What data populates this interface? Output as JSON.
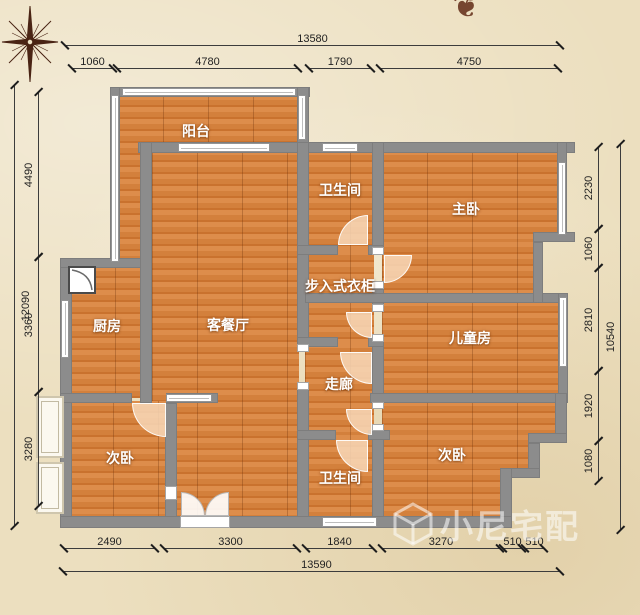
{
  "plan_title": "residential floor plan",
  "rooms": [
    {
      "id": "balcony",
      "label": "阳台"
    },
    {
      "id": "bathroom-top",
      "label": "卫生间"
    },
    {
      "id": "master-bedroom",
      "label": "主卧"
    },
    {
      "id": "walk-in-closet",
      "label": "步入式衣柜"
    },
    {
      "id": "kitchen",
      "label": "厨房"
    },
    {
      "id": "living-dining",
      "label": "客餐厅"
    },
    {
      "id": "kids-room",
      "label": "儿童房"
    },
    {
      "id": "corridor",
      "label": "走廊"
    },
    {
      "id": "bedroom-left",
      "label": "次卧"
    },
    {
      "id": "bathroom-bottom",
      "label": "卫生间"
    },
    {
      "id": "bedroom-right",
      "label": "次卧"
    }
  ],
  "dimensions": {
    "top": {
      "overall": "13580",
      "segments": [
        "1060",
        "4780",
        "1790",
        "4750"
      ]
    },
    "bottom": {
      "overall": "13590",
      "segments": [
        "2490",
        "3300",
        "1840",
        "3270",
        "510",
        "510"
      ]
    },
    "left": {
      "overall": "12090",
      "segments": [
        "4490",
        "3360",
        "3280"
      ]
    },
    "right": {
      "overall": "10540",
      "segments": [
        "2230",
        "1060",
        "2810",
        "1920",
        "1080"
      ]
    }
  },
  "watermark": {
    "text": "小尼宅配",
    "logo": "cube-logo"
  },
  "ornament_glyph": "❦",
  "colors": {
    "background": "#ecdfbf",
    "floor": "#d3803c",
    "wall": "#8c8c8c",
    "window": "#ffffff",
    "door_arc": "#f8d8b8",
    "room_label": "#ffffff",
    "dimension_text": "#222222",
    "compass": "#4a2414",
    "watermark": "rgba(255,255,255,0.55)"
  }
}
